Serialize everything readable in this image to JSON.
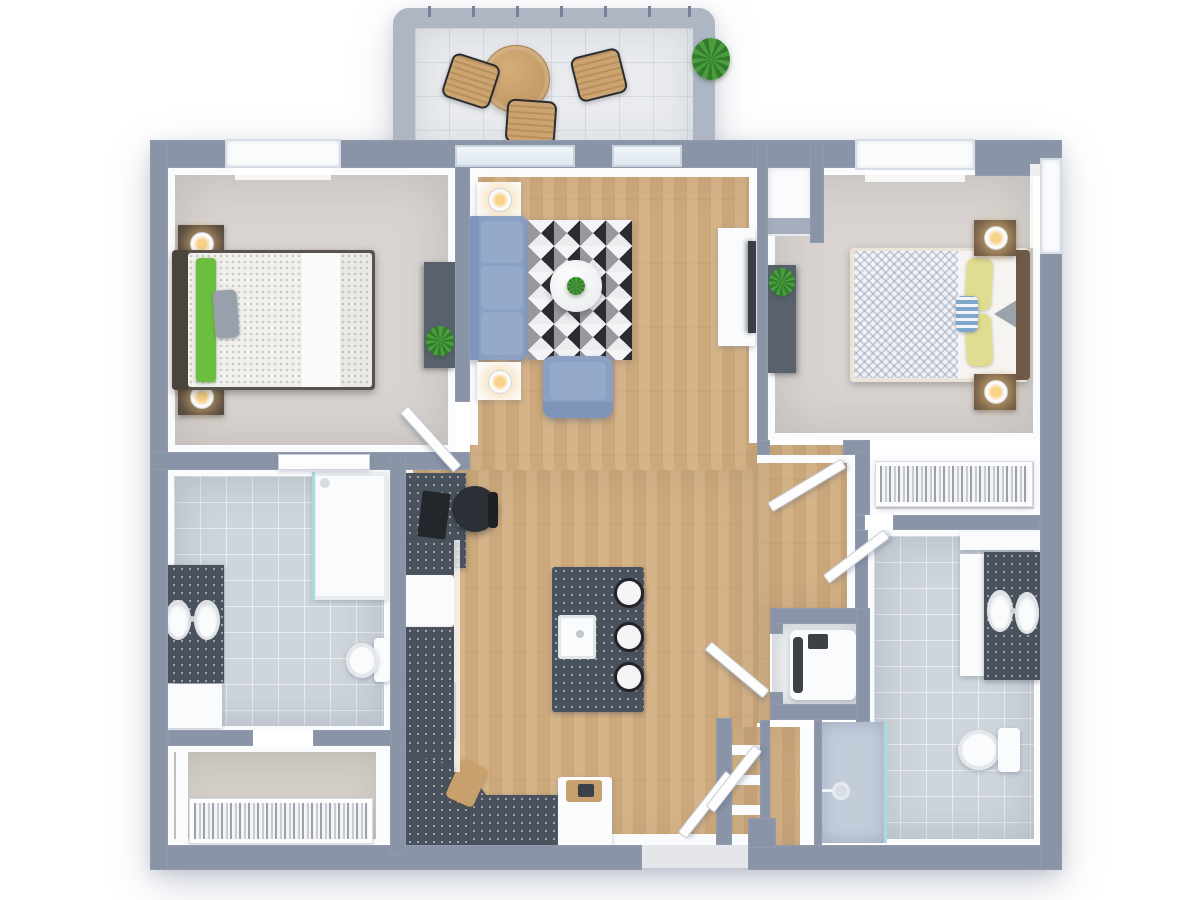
{
  "meta": {
    "kind": "3d-floor-plan-render",
    "view": "top-down",
    "visible_text": "none"
  },
  "colors": {
    "wall": "#8a94a7",
    "wallDark": "#76819a",
    "rail": "#aeb6c4",
    "white": "#fafbfd",
    "doorWhite": "#fdfdfe",
    "woodFloor": "#d3ae80",
    "carpet": "#d9d4d1",
    "tile": "#ced5db",
    "balcFloor": "#e9ebee",
    "closetFloor": "#d3cec8",
    "closetFloor2": "#e9e7e4",
    "showerFloor": "#c3cdda",
    "counter": "#49525d",
    "sofa": "#8ba1c4",
    "sofaLight": "#95aacb",
    "plantA": "#4d9c3f",
    "plantB": "#2f7d2b",
    "green": "#6cbf3e",
    "yellow": "#e0dc90",
    "headboard2": "#6e5a47",
    "bedframe1": "#5a534b",
    "darkFurn": "#59616d",
    "tv": "#3a3f46",
    "chairDark": "#2c3036",
    "glassTeal": "#a8dcd9"
  },
  "scene": {
    "balcony": {
      "furniture": [
        "round-wood-table",
        "slat-chair",
        "slat-chair",
        "slat-chair",
        "potted-plant"
      ],
      "features": [
        "railing",
        "sliding-glass-door"
      ]
    },
    "bedroom-1": {
      "furniture": [
        "double-bed",
        "green-throw",
        "gray-pillow",
        "nightstand-lamp",
        "nightstand-lamp",
        "dresser",
        "potted-plant"
      ],
      "features": [
        "window",
        "door",
        "sliding-door-to-bathroom"
      ]
    },
    "living-room": {
      "furniture": [
        "three-seat-sofa",
        "side-table-lamp",
        "side-table-lamp",
        "geometric-rug",
        "round-coffee-table",
        "armchair",
        "tv-console",
        "tv",
        "desk",
        "office-chair"
      ],
      "features": [
        "wood-floor"
      ]
    },
    "kitchen": {
      "furniture": [
        "counter-run",
        "fridge",
        "cooktop-4-burner",
        "curved-counter",
        "cutting-board",
        "end-cabinet",
        "island-with-sink",
        "bar-stool",
        "bar-stool",
        "bar-stool"
      ],
      "features": []
    },
    "bathroom-1": {
      "furniture": [
        "double-vanity",
        "sink",
        "sink",
        "walk-in-shower",
        "toilet"
      ],
      "features": [
        "tile-floor"
      ]
    },
    "walk-in-closet-1": {
      "furniture": [
        "clothes-rail"
      ],
      "features": []
    },
    "bedroom-2": {
      "furniture": [
        "double-bed",
        "yellow-pillows",
        "accent-pillow",
        "nightstand-lamp",
        "nightstand-lamp",
        "dresser",
        "potted-plant",
        "corner-closet"
      ],
      "features": [
        "window",
        "window",
        "door"
      ]
    },
    "walk-in-closet-2": {
      "furniture": [
        "clothes-rail"
      ],
      "features": []
    },
    "bathroom-2": {
      "furniture": [
        "double-vanity",
        "sink",
        "sink",
        "toilet",
        "walk-in-shower",
        "glass-panel"
      ],
      "features": [
        "tile-floor"
      ]
    },
    "laundry": {
      "furniture": [
        "washer"
      ],
      "features": [
        "door"
      ]
    },
    "entry": {
      "features": [
        "double-door",
        "shelved-closet",
        "shelved-closet"
      ]
    }
  }
}
